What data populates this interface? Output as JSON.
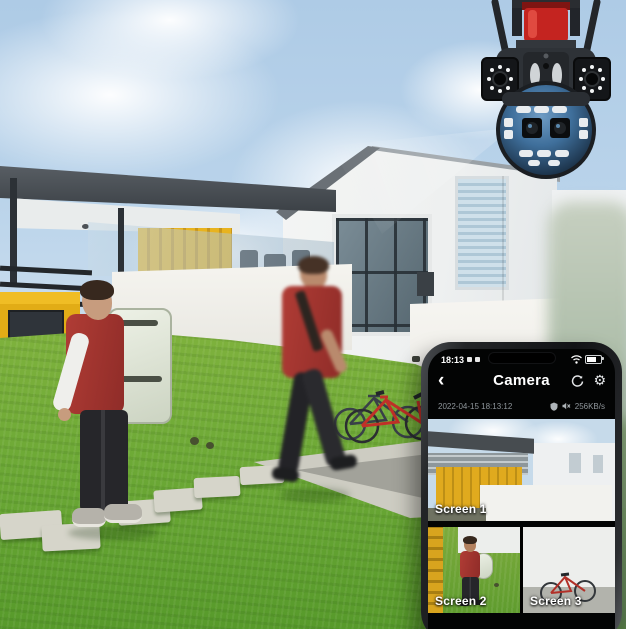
{
  "colors": {
    "sky": "#b9d3ea",
    "grass_green": "#6da936",
    "container_yellow": "#e6b01c",
    "shirt_red": "#a53a33",
    "camera_siren_red": "#c42420",
    "camera_dome_blue": "#3f6f9b",
    "phone_body_black": "#17181a",
    "screen_black": "#030404",
    "ui_text_white": "#ffffff",
    "ui_text_muted": "#8f969b"
  },
  "scene": {
    "camera_device": "dual-lens ptz security camera with antennas and red siren",
    "people_count": "2"
  },
  "phone": {
    "status_bar": {
      "time": "18:13"
    },
    "header": {
      "title": "Camera"
    },
    "info_bar": {
      "timestamp": "2022-04-15 18:13:12",
      "network_speed": "256KB/s"
    },
    "feeds": [
      {
        "label": "Screen 1"
      },
      {
        "label": "Screen 2"
      },
      {
        "label": "Screen 3"
      }
    ]
  }
}
